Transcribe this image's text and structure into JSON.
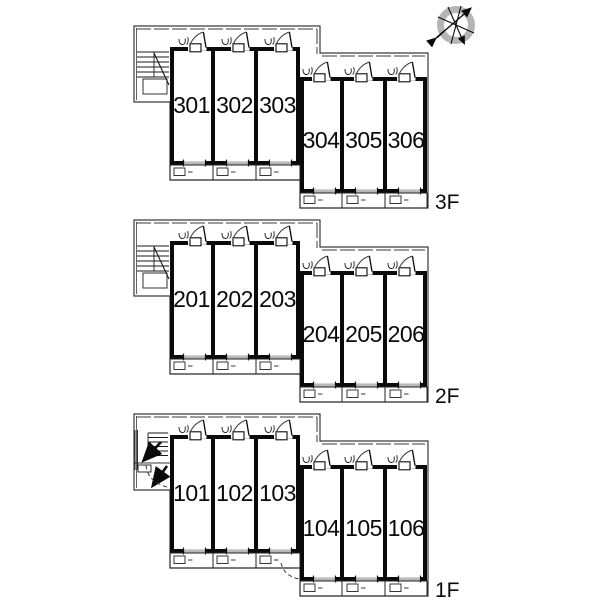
{
  "title": "apartment-building-floor-plan",
  "floors": [
    {
      "id": "3f",
      "label": "3F",
      "rooms": [
        "301",
        "302",
        "303",
        "304",
        "305",
        "306"
      ]
    },
    {
      "id": "2f",
      "label": "2F",
      "rooms": [
        "201",
        "202",
        "203",
        "204",
        "205",
        "206"
      ]
    },
    {
      "id": "1f",
      "label": "1F",
      "rooms": [
        "101",
        "102",
        "103",
        "104",
        "105",
        "106"
      ]
    }
  ],
  "icons": {
    "compass": "north-compass-rose",
    "stairs": "staircase",
    "door": "door-swing-with-meter",
    "balcony_unit": "balcony-equipment-box",
    "entrance": "entrance-arrow-up"
  },
  "colors": {
    "wall": "#0a0a0a",
    "outline": "#3a3a3a",
    "window": "#9a9a9a",
    "compass_ring": "#b5b5b5",
    "background": "#ffffff"
  }
}
